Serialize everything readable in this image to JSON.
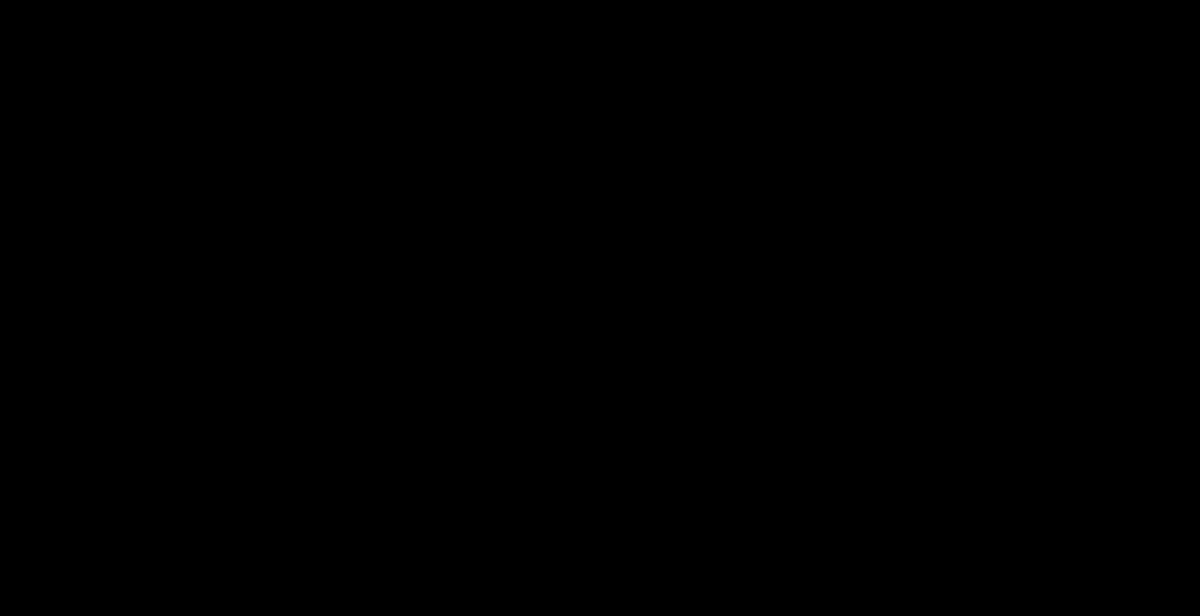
{
  "map_title": "Parcel map of Happyville City and Blissville City",
  "colors": {
    "background": "#3F8FF8",
    "parcel_line": "#1760C8",
    "building": "#1470E8",
    "building_outline": "#0A4FA8",
    "road_casing": "#A30202",
    "road_centerline": "#EF2400",
    "house_dot": "#C40000",
    "house_dot_outline": "#7F0000",
    "house_label": "#FFFFFF",
    "house_label_halo": "#0A2050",
    "street_label": "#FFFFFF",
    "street_label_halo": "#3F0000",
    "city_label": "#FF2BD2",
    "city_label_halo": "#FFFFFF",
    "boundary": "#FF00CC"
  },
  "cities": [
    {
      "name": "Happyville City",
      "lines": [
        "Happyville",
        "City"
      ],
      "x": 676,
      "y": 206,
      "line_gap": 18
    },
    {
      "name": "Blissville City",
      "lines": [
        "Blissville",
        "City"
      ],
      "x": 436,
      "y": 536,
      "line_gap": 17
    }
  ],
  "streets": [
    {
      "label": "BUELL RD",
      "x": 228,
      "y": 174,
      "angle": 0,
      "ls": 2.5
    },
    {
      "label": "PETERS AVE",
      "x": 900,
      "y": 47,
      "angle": 0,
      "ls": 2.5
    },
    {
      "label": "DAVIS RD",
      "x": 440,
      "y": 64,
      "angle": 90,
      "ls": 1.8
    },
    {
      "label": "VON ESSEN RD",
      "x": 22,
      "y": 408,
      "angle": 90,
      "ls": 1.8
    },
    {
      "label": "GOREHAM CIR",
      "x": 322,
      "y": 472,
      "angle": 92,
      "ls": 1.8
    },
    {
      "label": "BECK CR",
      "x": 672,
      "y": 292,
      "angle": 90,
      "ls": 1.8
    },
    {
      "label": "KELSON ST",
      "x": 902,
      "y": 224,
      "angle": -57,
      "ls": 1.8
    },
    {
      "label": "GREEN WAY",
      "x": 1064,
      "y": 440,
      "angle": -59,
      "ls": 1.8
    },
    {
      "label": "BECK ST",
      "x": 901,
      "y": 471,
      "angle": 36,
      "ls": 1.8
    },
    {
      "label": "BENJAMIN DR",
      "x": 577,
      "y": 521,
      "angle": 46,
      "ls": 1.8
    },
    {
      "label": "BUNCE CIR",
      "x": 1147,
      "y": 490,
      "angle": 11,
      "ls": 1.8
    }
  ],
  "houses": [
    [
      "1284",
      82,
      53,
      0,
      36,
      54
    ],
    [
      "1294",
      225,
      34,
      0,
      46,
      46
    ],
    [
      "1285",
      373,
      48,
      0,
      40,
      36
    ],
    [
      "1272",
      81,
      118,
      0,
      44,
      34
    ],
    [
      "1944",
      153,
      107,
      0,
      62,
      44
    ],
    [
      "1934",
      222,
      107,
      0,
      58,
      44
    ],
    [
      "1924",
      295,
      104,
      0,
      60,
      38
    ],
    [
      "1273",
      374,
      110,
      0,
      34,
      44
    ],
    [
      "",
      168,
      2
    ],
    [
      "",
      232,
      1
    ],
    [
      "",
      290,
      3
    ],
    [
      "",
      350,
      9
    ],
    [
      "1286",
      494,
      37,
      0,
      40,
      32
    ],
    [
      "1274",
      508,
      96,
      0,
      42,
      38
    ],
    [
      "1270",
      514,
      155,
      0,
      38,
      38
    ],
    [
      "1262",
      489,
      215,
      0,
      40,
      34
    ],
    [
      "1911",
      435,
      242,
      8
    ],
    [
      "1880",
      583,
      50,
      0,
      30,
      54
    ],
    [
      "1877",
      641,
      109,
      0,
      56,
      40
    ],
    [
      "1871",
      698,
      107,
      0,
      40,
      36
    ],
    [
      "1867",
      757,
      107,
      0,
      40,
      36
    ],
    [
      "1853",
      814,
      107,
      0,
      42,
      48
    ],
    [
      "1847",
      871,
      106,
      0,
      44,
      38
    ],
    [
      "1829",
      975,
      113,
      0,
      42,
      40
    ],
    [
      "1821",
      1032,
      111,
      0,
      42,
      36
    ],
    [
      "1277",
      1091,
      112,
      0,
      52,
      44
    ],
    [
      "",
      745,
      4
    ],
    [
      "",
      806,
      2
    ],
    [
      "",
      864,
      8
    ],
    [
      "",
      926,
      5
    ],
    [
      "",
      985,
      3
    ],
    [
      "",
      1185,
      8
    ],
    [
      "",
      1196,
      160,
      0,
      24,
      22
    ],
    [
      "1259",
      648,
      185,
      0,
      44,
      34
    ],
    [
      "1262",
      707,
      183,
      0,
      50,
      36
    ],
    [
      "1255",
      597,
      228,
      0,
      40,
      60
    ],
    [
      "1256",
      751,
      230,
      0,
      38,
      54
    ],
    [
      "1265",
      863,
      178,
      -20,
      52,
      36
    ],
    [
      "1257",
      881,
      239,
      -25,
      46,
      40
    ],
    [
      "1249",
      838,
      280,
      -30,
      46,
      48
    ],
    [
      "1248",
      731,
      300,
      -10,
      40,
      40
    ],
    [
      "1862",
      793,
      332,
      -15,
      46,
      38
    ],
    [
      "1243",
      598,
      297,
      0,
      52,
      46
    ],
    [
      "1881",
      597,
      370,
      -15,
      46,
      40
    ],
    [
      "1236",
      895,
      380,
      -25,
      46,
      38
    ],
    [
      "1264",
      981,
      190,
      -35,
      52,
      44
    ],
    [
      "1263",
      1087,
      193,
      -15,
      36,
      32
    ],
    [
      "1256",
      968,
      252,
      -30,
      50,
      40
    ],
    [
      "1255",
      1080,
      245,
      -10,
      38,
      36
    ],
    [
      "1247",
      1067,
      297,
      -10,
      38,
      40
    ],
    [
      "1244",
      943,
      317,
      -40,
      48,
      42
    ],
    [
      "1239",
      1053,
      340,
      -15,
      52,
      40
    ],
    [
      "1231",
      1032,
      388,
      -20,
      42,
      36
    ],
    [
      "1243",
      1190,
      337,
      -20,
      40,
      36
    ],
    [
      "1842",
      945,
      413,
      25,
      44,
      38
    ],
    [
      "1836",
      990,
      453,
      30,
      48,
      38
    ],
    [
      "1804",
      1155,
      440,
      0,
      52,
      38
    ],
    [
      "1953",
      76,
      235
    ],
    [
      "1945",
      138,
      233
    ],
    [
      "1935",
      200,
      232
    ],
    [
      "1927",
      258,
      232
    ],
    [
      "1921",
      316,
      231
    ],
    [
      "1917",
      373,
      230
    ],
    [
      "1952",
      74,
      317
    ],
    [
      "1948",
      138,
      317
    ],
    [
      "1936",
      200,
      317
    ],
    [
      "1928",
      257,
      317
    ],
    [
      "1920",
      308,
      316
    ],
    [
      "1912",
      376,
      329,
      8
    ],
    [
      "1904",
      437,
      343,
      18
    ],
    [
      "1896",
      508,
      371,
      32,
      60,
      44
    ],
    [
      "1949",
      89,
      445
    ],
    [
      "1941",
      157,
      444
    ],
    [
      "1933",
      215,
      443
    ],
    [
      "1217",
      276,
      443,
      0,
      40,
      52
    ],
    [
      "1206",
      106,
      511
    ],
    [
      "1207",
      235,
      509,
      0,
      44,
      50
    ],
    [
      "1198",
      124,
      566,
      -15,
      48,
      40
    ],
    [
      "1199",
      226,
      573,
      25,
      40,
      36
    ],
    [
      "1192",
      148,
      614,
      10
    ],
    [
      "1206",
      378,
      520,
      -15,
      44,
      40
    ],
    [
      "1198",
      371,
      575,
      22,
      48,
      44
    ],
    [
      "1907",
      388,
      449,
      -12,
      52,
      40
    ],
    [
      "1899",
      447,
      479,
      40,
      44,
      38
    ],
    [
      "1893",
      490,
      519,
      40,
      40,
      36
    ],
    [
      "1887",
      532,
      558,
      42,
      44,
      40
    ],
    [
      "1881",
      574,
      598,
      40,
      42,
      38
    ],
    [
      "1890",
      607,
      469,
      40,
      44,
      40
    ],
    [
      "1884",
      654,
      514,
      42,
      44,
      40
    ],
    [
      "1876",
      702,
      547,
      40,
      44,
      38
    ],
    [
      "1868",
      745,
      582,
      38,
      46,
      38
    ],
    [
      "1189",
      848,
      608,
      30,
      44,
      36
    ],
    [
      "1873",
      655,
      405,
      38,
      42,
      36
    ],
    [
      "1867",
      717,
      420,
      40,
      44,
      38
    ],
    [
      "1861",
      767,
      447,
      40,
      46,
      40
    ],
    [
      "1853",
      815,
      477,
      40,
      46,
      42
    ],
    [
      "1845",
      862,
      513,
      42,
      42,
      38
    ],
    [
      "1837",
      907,
      552,
      35,
      42,
      36
    ],
    [
      "1807",
      1081,
      565,
      12,
      50,
      44
    ],
    [
      "1803",
      1133,
      564,
      0,
      48,
      42
    ],
    [
      "1759",
      1199,
      568,
      0,
      44,
      40
    ],
    [
      "",
      525,
      612,
      40
    ],
    [
      "",
      628,
      612,
      0,
      36,
      28
    ]
  ]
}
